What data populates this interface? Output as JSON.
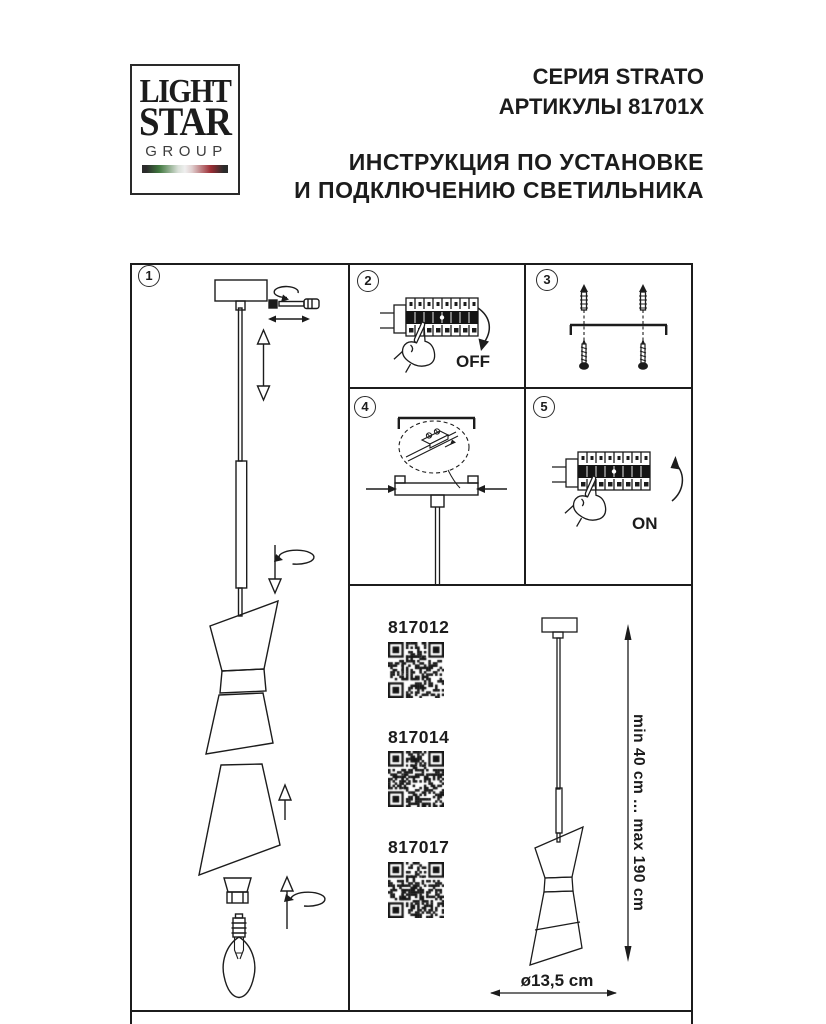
{
  "logo": {
    "line1": "LIGHT",
    "line2": "STAR",
    "line3": "GROUP"
  },
  "header": {
    "series": "СЕРИЯ STRATO",
    "articles": "АРТИКУЛЫ 81701X",
    "instruction_line1": "ИНСТРУКЦИЯ ПО УСТАНОВКЕ",
    "instruction_line2": "И ПОДКЛЮЧЕНИЮ СВЕТИЛЬНИКА"
  },
  "steps": [
    {
      "number": "1"
    },
    {
      "number": "2"
    },
    {
      "number": "3"
    },
    {
      "number": "4"
    },
    {
      "number": "5"
    }
  ],
  "step_labels": {
    "power_off": "OFF",
    "power_on": "ON"
  },
  "products": [
    {
      "code": "817012"
    },
    {
      "code": "817014"
    },
    {
      "code": "817017"
    }
  ],
  "dimensions": {
    "suspension_height": "min 40 cm ... max 190 cm",
    "shade_diameter": "ø13,5 cm"
  },
  "colors": {
    "line": "#1c1c1c",
    "flag_green": "#41783f",
    "flag_red": "#9c2d34",
    "flag_dark": "#2b2b2b"
  }
}
